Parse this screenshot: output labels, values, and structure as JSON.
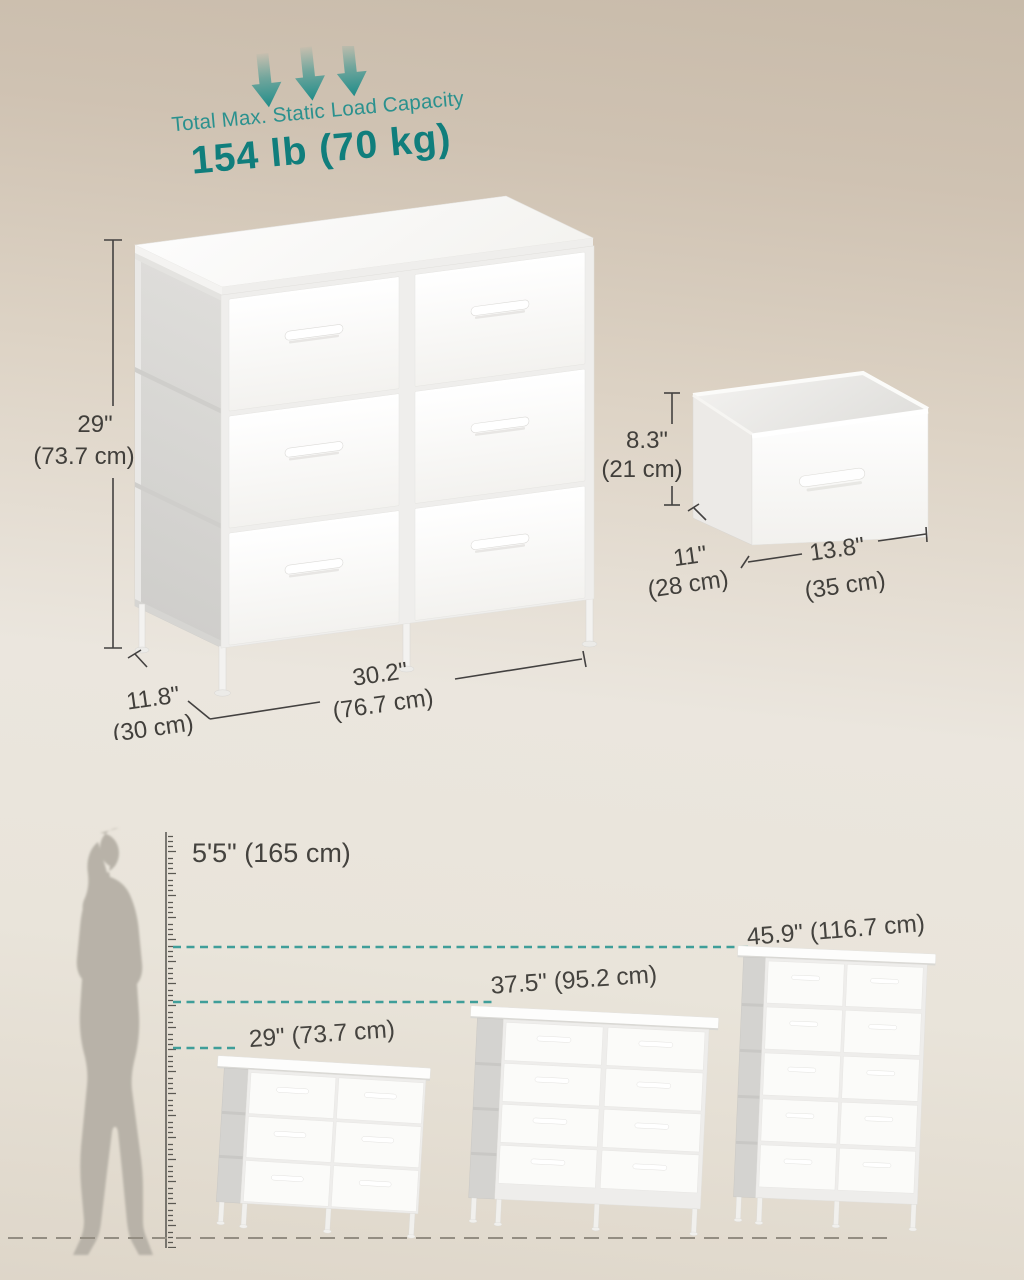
{
  "load_capacity": {
    "label": "Total Max. Static Load Capacity",
    "value": "154 lb (70 kg)"
  },
  "main_dresser": {
    "height_in": "29\"",
    "height_cm": "(73.7 cm)",
    "depth_in": "11.8\"",
    "depth_cm": "(30 cm)",
    "width_in": "30.2\"",
    "width_cm": "(76.7 cm)"
  },
  "drawer_bin": {
    "height_in": "8.3\"",
    "height_cm": "(21 cm)",
    "depth_in": "11\"",
    "depth_cm": "(28 cm)",
    "width_in": "13.8\"",
    "width_cm": "(35 cm)"
  },
  "size_comparison": {
    "person_height": "5'5\" (165 cm)",
    "options": [
      {
        "label": "29\" (73.7 cm)",
        "drawer_count": 6
      },
      {
        "label": "37.5\" (95.2 cm)",
        "drawer_count": 8
      },
      {
        "label": "45.9\" (116.7 cm)",
        "drawer_count": 10
      }
    ]
  },
  "icons": {
    "load_direction": "down-arrow-icon"
  },
  "colors": {
    "teal": "#2b918e",
    "teal_dark": "#107e7c",
    "dashed_line": "#3f9e99",
    "dimension_text": "#413f3b",
    "background_top": "#c8bbaa",
    "background_bottom": "#ded6c9"
  }
}
